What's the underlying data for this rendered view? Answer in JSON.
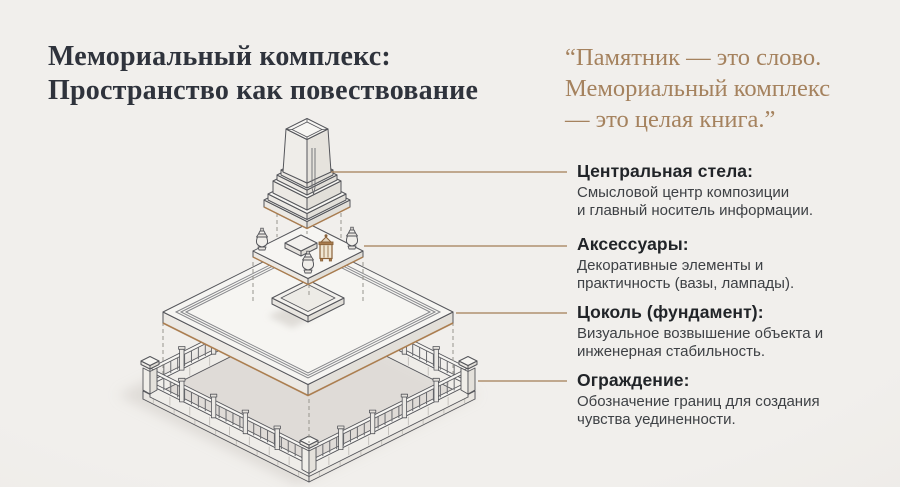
{
  "palette": {
    "background": "#efedea",
    "title": "#2f333c",
    "quote": "#a5825e",
    "heading": "#212428",
    "body_text": "#3e4145",
    "connector_line": "#a47e56",
    "illustration_outline": "#54555a",
    "illustration_fill_light": "#f6f5f2",
    "illustration_fill_mid": "#e9e6e1",
    "accent_brown": "#ac7f51"
  },
  "title": {
    "text": "Мемориальный комплекс:\nПространство как повествование"
  },
  "quote": {
    "text": "“Памятник — это слово.\nМемориальный комплекс\n— это целая книга.”"
  },
  "callouts": [
    {
      "heading": "Центральная стела:",
      "body": "Смысловой центр композиции\nи главный носитель информации."
    },
    {
      "heading": "Аксессуары:",
      "body": "Декоративные элементы и\nпрактичность (вазы, лампады)."
    },
    {
      "heading": "Цоколь (фундамент):",
      "body": "Визуальное возвышение объекта и\nинженерная стабильность."
    },
    {
      "heading": "Ограждение:",
      "body": "Обозначение границ для создания\nчувства уединенности."
    }
  ]
}
